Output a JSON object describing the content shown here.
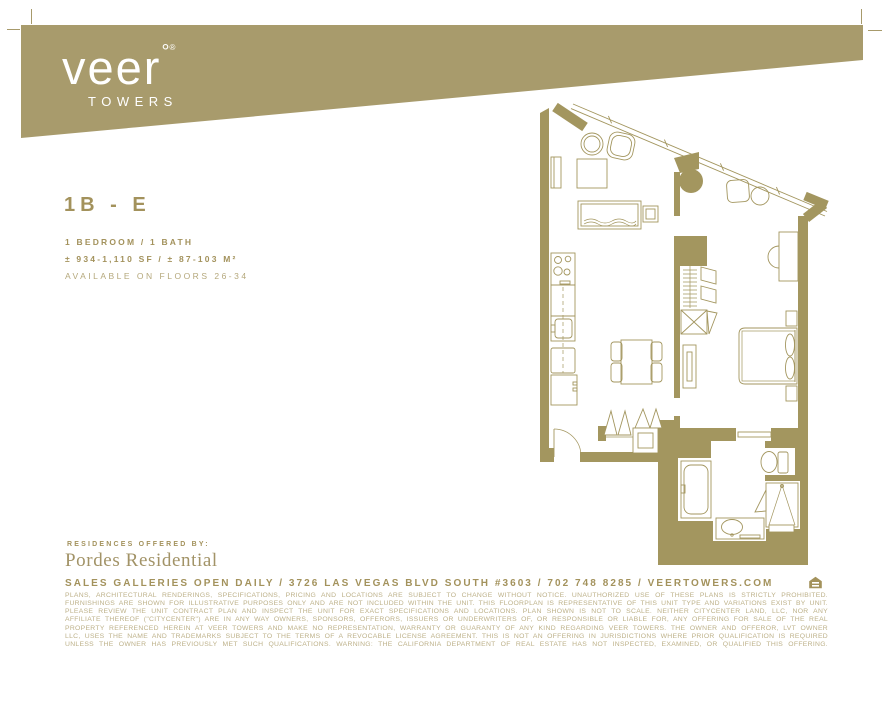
{
  "brand": {
    "logo_text": "veer",
    "logo_degree": "°",
    "logo_registered": "®",
    "tagline": "TOWERS",
    "banner_color": "#a89b6c"
  },
  "plan_info": {
    "title": "1B - E",
    "specs": [
      "1 BEDROOM / 1 BATH",
      "± 934-1,110 SF / ± 87-103 M²",
      "AVAILABLE ON FLOORS 26-34"
    ]
  },
  "offered_by": {
    "label": "RESIDENCES OFFERED BY:",
    "name": "Pordes Residential"
  },
  "contact": {
    "line": "SALES GALLERIES OPEN DAILY / 3726 LAS VEGAS BLVD SOUTH #3603 / 702 748 8285 / VEERTOWERS.COM",
    "icon": "equal-housing-logo"
  },
  "disclaimer": {
    "lines": [
      "PLANS, ARCHITECTURAL RENDERINGS, SPECIFICATIONS, PRICING AND LOCATIONS ARE SUBJECT TO CHANGE WITHOUT NOTICE. UNAUTHORIZED USE OF THESE PLANS IS STRICTLY PROHIBITED.",
      "FURNISHINGS ARE SHOWN FOR ILLUSTRATIVE PURPOSES ONLY AND ARE NOT INCLUDED WITHIN THE UNIT. THIS FLOORPLAN IS REPRESENTATIVE OF THIS UNIT TYPE AND VARIATIONS EXIST BY UNIT.",
      "PLEASE REVIEW THE UNIT CONTRACT PLAN AND INSPECT THE UNIT FOR EXACT SPECIFICATIONS AND LOCATIONS. PLAN SHOWN IS NOT TO SCALE. NEITHER CITYCENTER LAND, LLC, NOR ANY",
      "AFFILIATE THEREOF (\"CITYCENTER\") ARE IN ANY WAY OWNERS, SPONSORS, OFFERORS, ISSUERS OR UNDERWRITERS OF, OR RESPONSIBLE OR LIABLE FOR, ANY OFFERING FOR SALE OF THE REAL",
      "PROPERTY REFERENCED HEREIN AT VEER TOWERS AND MAKE NO REPRESENTATION, WARRANTY OR GUARANTY OF ANY KIND REGARDING VEER TOWERS. THE OWNER AND OFFEROR, LVT OWNER",
      "LLC, USES THE NAME AND TRADEMARKS SUBJECT TO THE TERMS OF A REVOCABLE LICENSE AGREEMENT. THIS IS NOT AN OFFERING IN JURISDICTIONS WHERE PRIOR QUALIFICATION IS REQUIRED",
      "UNLESS THE OWNER HAS PREVIOUSLY MET SUCH QUALIFICATIONS. WARNING: THE CALIFORNIA DEPARTMENT OF REAL ESTATE HAS NOT INSPECTED, EXAMINED, OR QUALIFIED THIS OFFERING."
    ]
  },
  "colors": {
    "gold_banner": "#a89b6c",
    "gold_wall": "#a3965f",
    "gold_text": "#a3925c",
    "gold_light": "#b5a87c",
    "fine_print_text": "#bdb189"
  }
}
